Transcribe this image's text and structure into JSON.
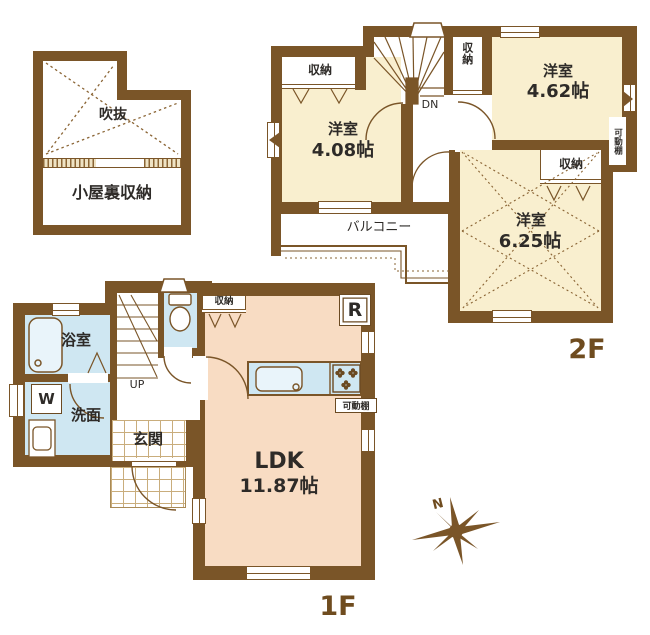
{
  "colors": {
    "wall": "#7a5528",
    "room_cream": "#f9efcf",
    "room_peach": "#f8dcc3",
    "room_blue": "#cfe7f2",
    "label_text": "#2e2b28",
    "floor_label_text": "#6f4c1f"
  },
  "attic": {
    "void_label": "吹抜",
    "storage_label": "小屋裏収納"
  },
  "floor2": {
    "floor_label": "2F",
    "stairs_label": "DN",
    "closet_west": "収納",
    "closet_mid": "収納",
    "closet_south": "収納",
    "movable_shelf": "可動棚",
    "balcony_label": "バルコニー",
    "room_west": {
      "name": "洋室",
      "size": "4.08帖"
    },
    "room_east": {
      "name": "洋室",
      "size": "4.62帖"
    },
    "room_south": {
      "name": "洋室",
      "size": "6.25帖"
    }
  },
  "floor1": {
    "floor_label": "1F",
    "stairs_label": "UP",
    "bath_label": "浴室",
    "washroom_label": "洗面",
    "washer_label": "W",
    "entrance_label": "玄関",
    "closet_label": "収納",
    "refrigerator_label": "R",
    "movable_shelf": "可動棚",
    "ldk": {
      "name": "LDK",
      "size": "11.87帖"
    }
  },
  "compass": {
    "north_label": "N"
  }
}
